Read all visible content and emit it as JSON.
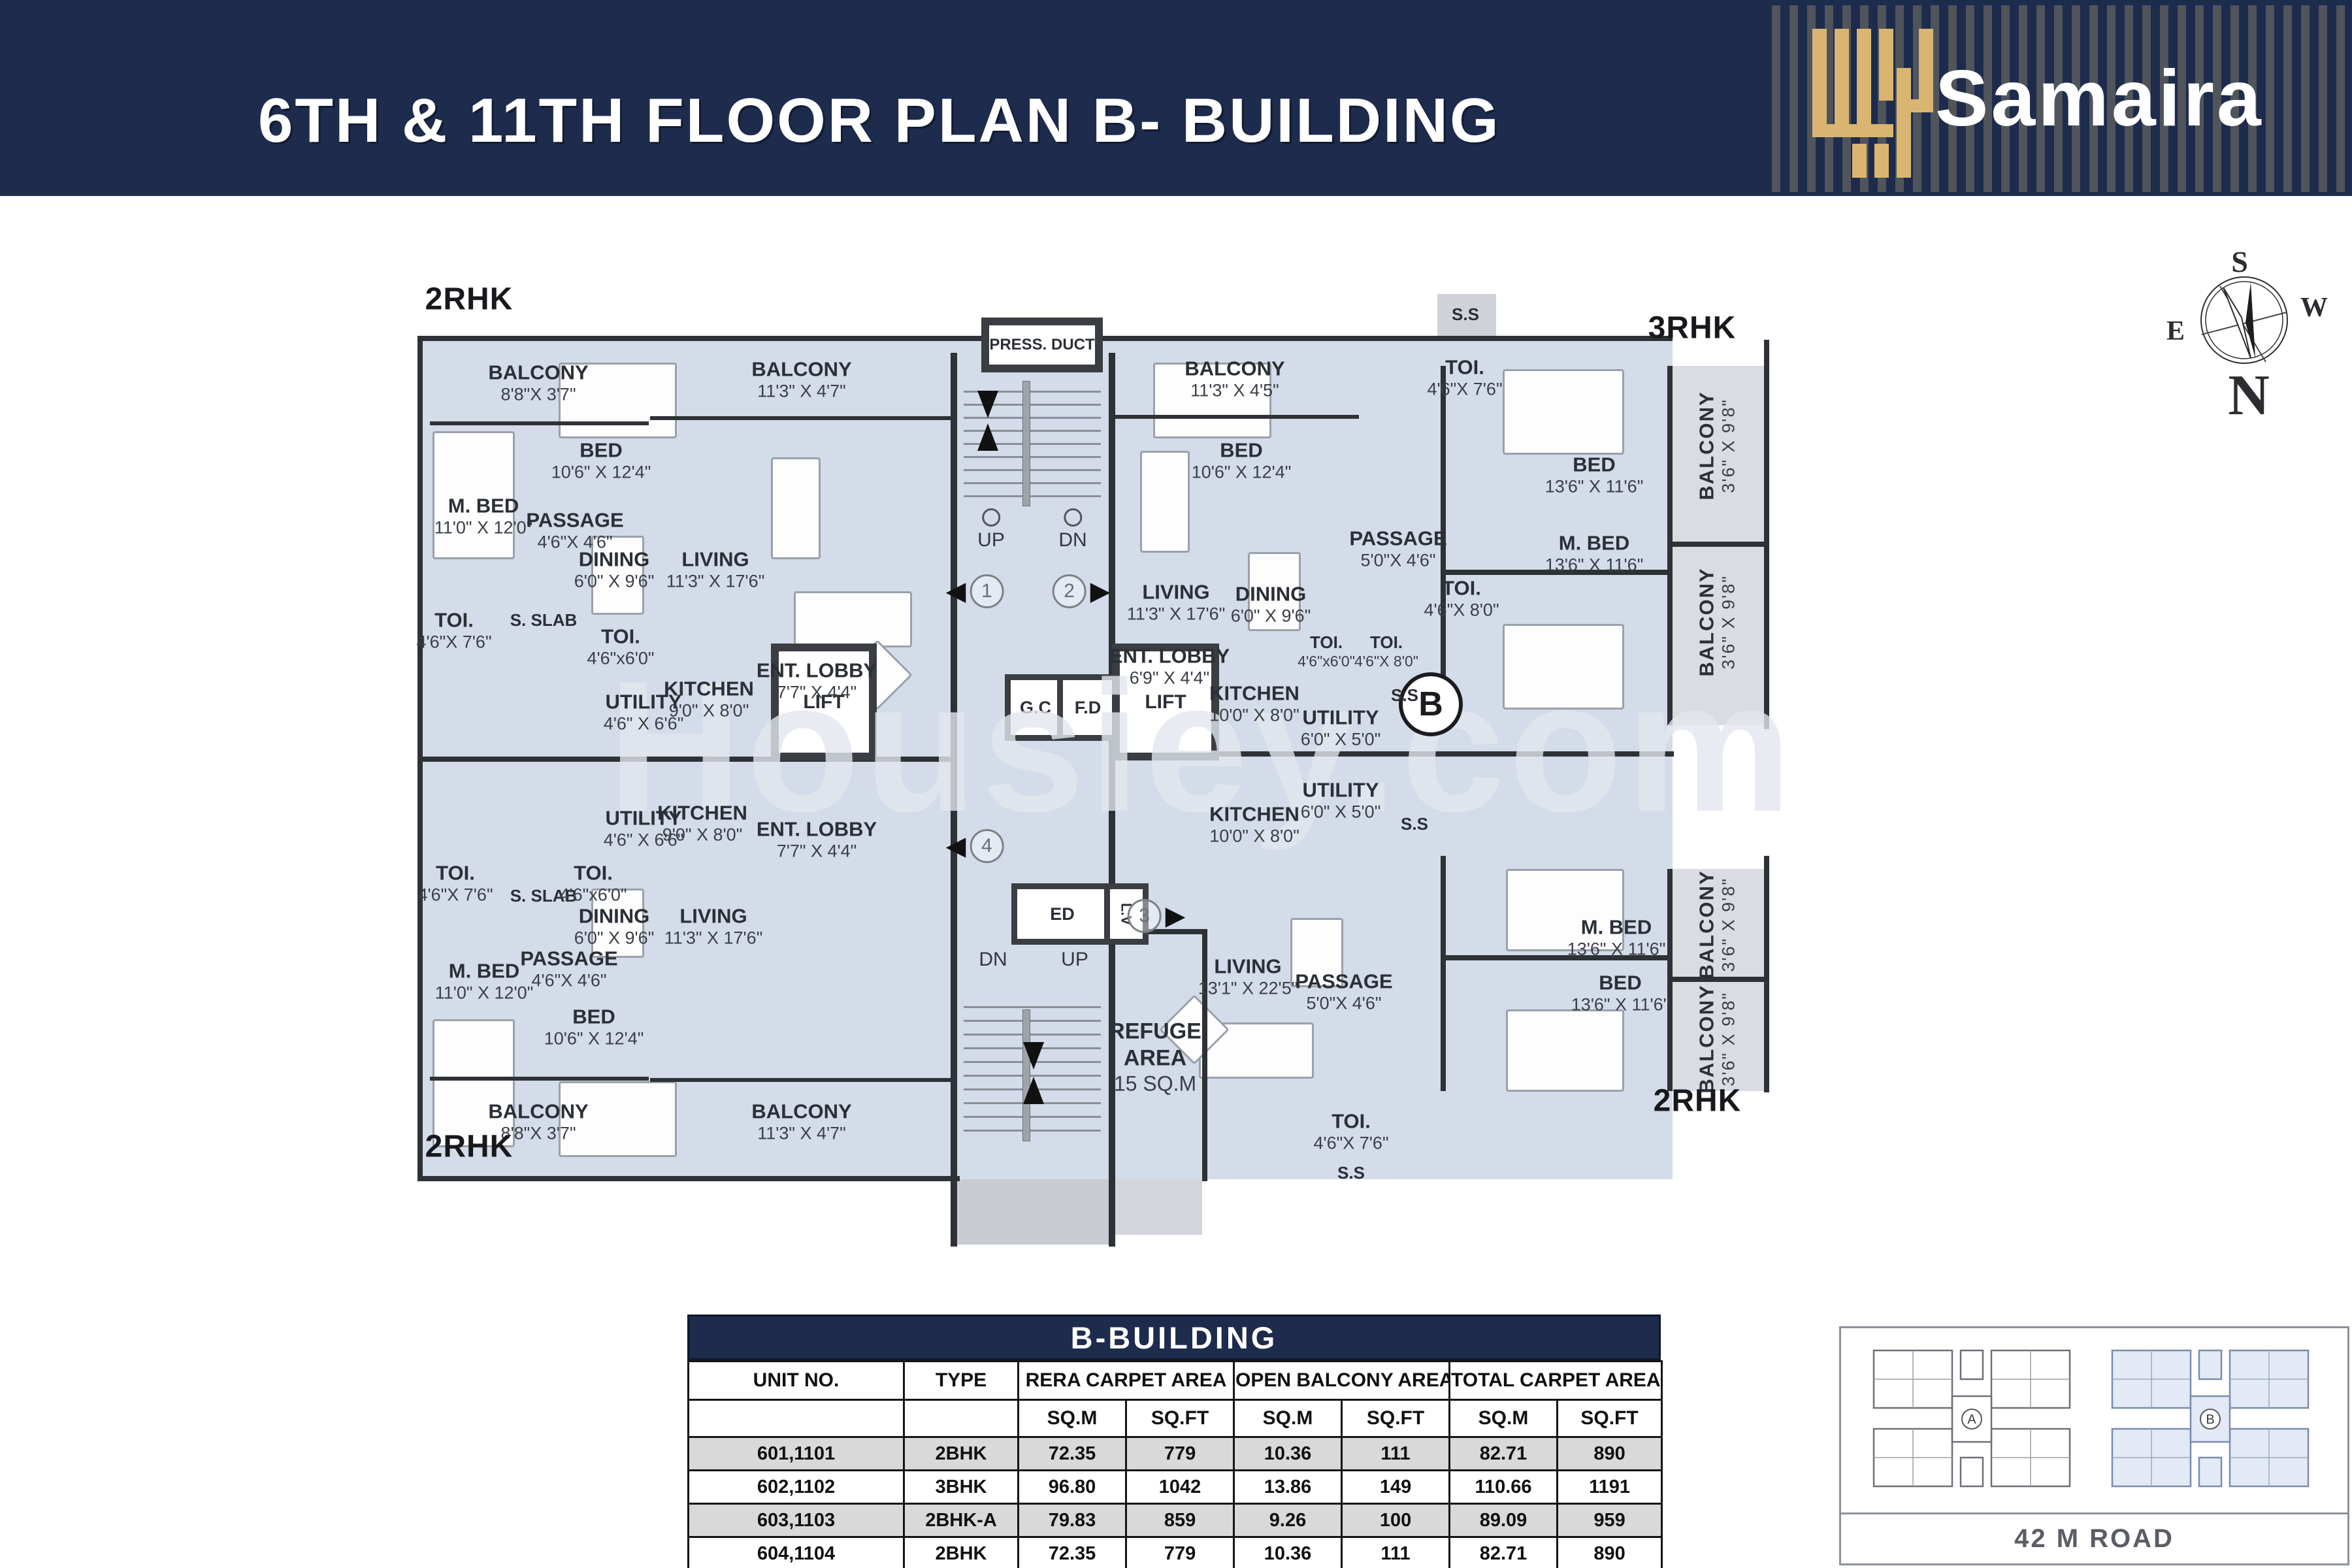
{
  "header": {
    "title": "6TH & 11TH FLOOR PLAN B- BUILDING",
    "brand": "Samaira"
  },
  "colors": {
    "navy": "#1d2b4d",
    "gold": "#d9b571",
    "room_fill": "#d4dbe9",
    "balcony_fill": "#d9dce2",
    "core_fill": "#c9ccd2",
    "wall": "#2e3135",
    "table_row_alt": "#d9d9d9"
  },
  "compass": {
    "north": "N",
    "south": "S",
    "east": "E",
    "west": "W"
  },
  "plan": {
    "watermark": "Housiey.com",
    "unit_labels": [
      {
        "id": "u1",
        "text": "2RHK"
      },
      {
        "id": "u2",
        "text": "3RHK"
      },
      {
        "id": "u3",
        "text": "2RHK"
      },
      {
        "id": "u4",
        "text": "2RHK"
      }
    ],
    "core": {
      "press_duct": "PRESS. DUCT",
      "up": "UP",
      "dn": "DN",
      "gc": "G.C",
      "fd": "F.D",
      "lift": "LIFT",
      "ed": "ED",
      "lv": "L.V",
      "b_marker": "B",
      "refuge_1": "REFUGE",
      "refuge_2": "AREA",
      "refuge_3": "15  SQ.M",
      "markers": [
        "1",
        "2",
        "3",
        "4"
      ]
    },
    "rooms": [
      {
        "id": "balcony-a",
        "name": "BALCONY",
        "dims": "8'8\"X 3'7\""
      },
      {
        "id": "balcony-b",
        "name": "BALCONY",
        "dims": "11'3\" X 4'7\""
      },
      {
        "id": "bed-a",
        "name": "BED",
        "dims": "10'6\" X 12'4\""
      },
      {
        "id": "mbed-a",
        "name": "M. BED",
        "dims": "11'0\" X 12'0\""
      },
      {
        "id": "passage-a",
        "name": "PASSAGE",
        "dims": "4'6\"X 4'6\""
      },
      {
        "id": "living-a",
        "name": "LIVING",
        "dims": "11'3\" X 17'6\""
      },
      {
        "id": "dining-a",
        "name": "DINING",
        "dims": "6'0\" X 9'6\""
      },
      {
        "id": "toi-a",
        "name": "TOI.",
        "dims": "4'6\"X 7'6\""
      },
      {
        "id": "sslab-a",
        "name": "S. SLAB",
        "dims": ""
      },
      {
        "id": "toi-b",
        "name": "TOI.",
        "dims": "4'6\"x6'0\""
      },
      {
        "id": "utility-a",
        "name": "UTILITY",
        "dims": "4'6\" X 6'6\""
      },
      {
        "id": "kitchen-a",
        "name": "KITCHEN",
        "dims": "9'0\" X 8'0\""
      },
      {
        "id": "lobby-a",
        "name": "ENT. LOBBY",
        "dims": "7'7\" X 4'4\""
      },
      {
        "id": "balcony-c",
        "name": "BALCONY",
        "dims": "11'3\" X 4'5\""
      },
      {
        "id": "bed-b",
        "name": "BED",
        "dims": "10'6\" X 12'4\""
      },
      {
        "id": "passage-b",
        "name": "PASSAGE",
        "dims": "5'0\"X 4'6\""
      },
      {
        "id": "ss-a",
        "name": "S.S",
        "dims": ""
      },
      {
        "id": "toi-c",
        "name": "TOI.",
        "dims": "4'6\"X 7'6\""
      },
      {
        "id": "bed-c",
        "name": "BED",
        "dims": "13'6\" X 11'6\""
      },
      {
        "id": "mbed-b",
        "name": "M. BED",
        "dims": "13'6\" X 11'6\""
      },
      {
        "id": "balcony-d",
        "name": "BALCONY",
        "dims": "3'6\" X 9'8\""
      },
      {
        "id": "balcony-e",
        "name": "BALCONY",
        "dims": "3'6\" X 9'8\""
      },
      {
        "id": "toi-d",
        "name": "TOI.",
        "dims": "4'6\"X 8'0\""
      },
      {
        "id": "living-b",
        "name": "LIVING",
        "dims": "11'3\" X 17'6\""
      },
      {
        "id": "dining-b",
        "name": "DINING",
        "dims": "6'0\" X 9'6\""
      },
      {
        "id": "kitchen-b",
        "name": "KITCHEN",
        "dims": "10'0\" X 8'0\""
      },
      {
        "id": "toi-e",
        "name": "TOI.",
        "dims": "4'6\"x6'0\""
      },
      {
        "id": "toi-f",
        "name": "TOI.",
        "dims": "4'6\"X 8'0\""
      },
      {
        "id": "utility-b",
        "name": "UTILITY",
        "dims": "6'0\" X 5'0\""
      },
      {
        "id": "ss-b",
        "name": "S.S",
        "dims": ""
      },
      {
        "id": "lobby-b",
        "name": "ENT. LOBBY",
        "dims": "6'9\" X 4'4\""
      },
      {
        "id": "toi-g",
        "name": "TOI.",
        "dims": "4'6\"X 7'6\""
      },
      {
        "id": "sslab-b",
        "name": "S. SLAB",
        "dims": ""
      },
      {
        "id": "toi-h",
        "name": "TOI.",
        "dims": "4'6\"x6'0\""
      },
      {
        "id": "utility-c",
        "name": "UTILITY",
        "dims": "4'6\" X 6'6\""
      },
      {
        "id": "kitchen-c",
        "name": "KITCHEN",
        "dims": "9'0\" X 8'0\""
      },
      {
        "id": "lobby-c",
        "name": "ENT. LOBBY",
        "dims": "7'7\" X 4'4\""
      },
      {
        "id": "dining-c",
        "name": "DINING",
        "dims": "6'0\" X 9'6\""
      },
      {
        "id": "living-c",
        "name": "LIVING",
        "dims": "11'3\" X 17'6\""
      },
      {
        "id": "passage-c",
        "name": "PASSAGE",
        "dims": "4'6\"X 4'6\""
      },
      {
        "id": "mbed-c",
        "name": "M. BED",
        "dims": "11'0\" X 12'0\""
      },
      {
        "id": "bed-d",
        "name": "BED",
        "dims": "10'6\" X 12'4\""
      },
      {
        "id": "balcony-f",
        "name": "BALCONY",
        "dims": "8'8\"X 3'7\""
      },
      {
        "id": "balcony-g",
        "name": "BALCONY",
        "dims": "11'3\" X 4'7\""
      },
      {
        "id": "kitchen-d",
        "name": "KITCHEN",
        "dims": "10'0\" X 8'0\""
      },
      {
        "id": "utility-d",
        "name": "UTILITY",
        "dims": "6'0\" X 5'0\""
      },
      {
        "id": "ss-c",
        "name": "S.S",
        "dims": ""
      },
      {
        "id": "living-d",
        "name": "LIVING",
        "dims": "13'1\" X 22'5\""
      },
      {
        "id": "passage-d",
        "name": "PASSAGE",
        "dims": "5'0\"X 4'6\""
      },
      {
        "id": "mbed-d",
        "name": "M. BED",
        "dims": "13'6\" X 11'6\""
      },
      {
        "id": "bed-e",
        "name": "BED",
        "dims": "13'6\" X 11'6\""
      },
      {
        "id": "balcony-h",
        "name": "BALCONY",
        "dims": "3'6\" X 9'8\""
      },
      {
        "id": "balcony-i",
        "name": "BALCONY",
        "dims": "3'6\" X 9'8\""
      },
      {
        "id": "toi-i",
        "name": "TOI.",
        "dims": "4'6\"X 7'6\""
      },
      {
        "id": "ss-d",
        "name": "S.S",
        "dims": ""
      }
    ]
  },
  "table": {
    "title": "B-BUILDING",
    "col_groups": [
      "UNIT NO.",
      "TYPE",
      "RERA CARPET AREA",
      "OPEN BALCONY AREA",
      "TOTAL CARPET AREA"
    ],
    "sub_headers": [
      "",
      "",
      "SQ.M",
      "SQ.FT",
      "SQ.M",
      "SQ.FT",
      "SQ.M",
      "SQ.FT"
    ],
    "rows": [
      [
        "601,1101",
        "2BHK",
        "72.35",
        "779",
        "10.36",
        "111",
        "82.71",
        "890"
      ],
      [
        "602,1102",
        "3BHK",
        "96.80",
        "1042",
        "13.86",
        "149",
        "110.66",
        "1191"
      ],
      [
        "603,1103",
        "2BHK-A",
        "79.83",
        "859",
        "9.26",
        "100",
        "89.09",
        "959"
      ],
      [
        "604,1104",
        "2BHK",
        "72.35",
        "779",
        "10.36",
        "111",
        "82.71",
        "890"
      ]
    ]
  },
  "siteplan": {
    "a": "A",
    "b": "B",
    "road": "42 M ROAD"
  }
}
